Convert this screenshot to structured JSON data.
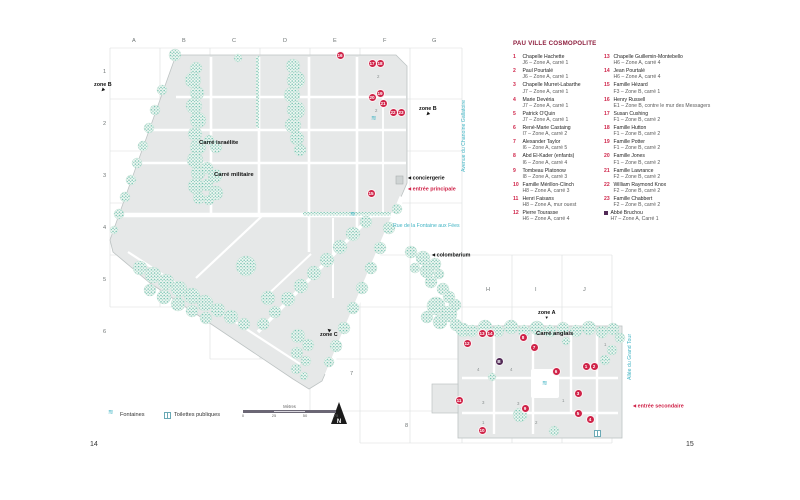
{
  "page": {
    "left_number": "14",
    "right_number": "15"
  },
  "legend_panel": {
    "title": "PAU VILLE COSMOPOLITE",
    "entries_col1": [
      {
        "num": "1",
        "name": "Chapelle Hachette",
        "loc": "J6 – Zone A, carré 1"
      },
      {
        "num": "2",
        "name": "Paul Pourtalé",
        "loc": "J6 – Zone A, carré 1"
      },
      {
        "num": "3",
        "name": "Chapelle Murret-Labarthe",
        "loc": "J7 – Zone A, carré 1"
      },
      {
        "num": "4",
        "name": "Marie Devéria",
        "loc": "J7 – Zone A, carré 1"
      },
      {
        "num": "5",
        "name": "Patrick O'Quin",
        "loc": "J7 – Zone A, carré 1"
      },
      {
        "num": "6",
        "name": "René-Marie Castaing",
        "loc": "I7 – Zone A, carré 2"
      },
      {
        "num": "7",
        "name": "Alexander Taylor",
        "loc": "I6 – Zone A, carré 5"
      },
      {
        "num": "8",
        "name": "Abd El-Kader (enfants)",
        "loc": "I6 – Zone A, carré 4"
      },
      {
        "num": "9",
        "name": "Tombeau Platonow",
        "loc": "I8 – Zone A, carré 3"
      },
      {
        "num": "10",
        "name": "Famille Mérillon-Clinch",
        "loc": "H8 – Zone A, carré 3"
      },
      {
        "num": "11",
        "name": "Henri Faisans",
        "loc": "H8 – Zone A, mur ouest"
      },
      {
        "num": "12",
        "name": "Pierre Tourasse",
        "loc": "H6 – Zone A, carré 4"
      }
    ],
    "entries_col2": [
      {
        "num": "13",
        "name": "Chapelle Guillemin-Montebello",
        "loc": "H6 – Zone A, carré 4"
      },
      {
        "num": "14",
        "name": "Jean Pourtalé",
        "loc": "H6 – Zone A, carré 4"
      },
      {
        "num": "15",
        "name": "Famille Hézard",
        "loc": "F3 – Zone B, carré 1"
      },
      {
        "num": "16",
        "name": "Henry Russell",
        "loc": "E1 – Zone B, contre le mur des Messagers"
      },
      {
        "num": "17",
        "name": "Susan Cushing",
        "loc": "F1 – Zone B, carré 2"
      },
      {
        "num": "18",
        "name": "Famille Hutton",
        "loc": "F1 – Zone B, carré 2"
      },
      {
        "num": "19",
        "name": "Famille Potter",
        "loc": "F1 – Zone B, carré 2"
      },
      {
        "num": "20",
        "name": "Famille Jones",
        "loc": "F1 – Zone B, carré 2"
      },
      {
        "num": "21",
        "name": "Famille Lawrance",
        "loc": "F2 – Zone B, carré 2"
      },
      {
        "num": "22",
        "name": "William Raymond Knox",
        "loc": "F2 – Zone B, carré 2"
      },
      {
        "num": "23",
        "name": "Famille Chabbert",
        "loc": "F2 – Zone B, carré 2"
      },
      {
        "num": "B",
        "square": true,
        "name": "Abbé Bruchou",
        "loc": "H7 – Zone A, Carré 1"
      }
    ]
  },
  "map": {
    "grid": {
      "cols": [
        {
          "label": "A",
          "x": 132,
          "y": 38
        },
        {
          "label": "B",
          "x": 182,
          "y": 38
        },
        {
          "label": "C",
          "x": 232,
          "y": 38
        },
        {
          "label": "D",
          "x": 283,
          "y": 38
        },
        {
          "label": "E",
          "x": 333,
          "y": 38
        },
        {
          "label": "F",
          "x": 383,
          "y": 38
        },
        {
          "label": "G",
          "x": 432,
          "y": 38
        },
        {
          "label": "H",
          "x": 486,
          "y": 287
        },
        {
          "label": "I",
          "x": 535,
          "y": 287
        },
        {
          "label": "J",
          "x": 583,
          "y": 287
        }
      ],
      "rows": [
        {
          "label": "1",
          "x": 103,
          "y": 69
        },
        {
          "label": "2",
          "x": 103,
          "y": 121
        },
        {
          "label": "3",
          "x": 103,
          "y": 173
        },
        {
          "label": "4",
          "x": 103,
          "y": 225
        },
        {
          "label": "5",
          "x": 103,
          "y": 277
        },
        {
          "label": "6",
          "x": 103,
          "y": 329
        },
        {
          "label": "7",
          "x": 350,
          "y": 371
        },
        {
          "label": "8",
          "x": 405,
          "y": 423
        }
      ]
    },
    "zone_labels": [
      {
        "text": "zone B",
        "x": 94,
        "y": 82,
        "dir": "sw",
        "arrow_first": false
      },
      {
        "text": "zone B",
        "x": 419,
        "y": 106,
        "dir": "sw",
        "arrow_first": false
      },
      {
        "text": "zone A",
        "x": 538,
        "y": 310,
        "dir": "s",
        "arrow_first": false
      },
      {
        "text": "zone C",
        "x": 320,
        "y": 328,
        "dir": "nw",
        "arrow_first": true
      }
    ],
    "poi_labels": [
      {
        "text": "conciergerie",
        "x": 408,
        "y": 175,
        "red": false
      },
      {
        "text": "entrée principale",
        "x": 408,
        "y": 186,
        "red": true
      },
      {
        "text": "colombarium",
        "x": 432,
        "y": 252,
        "red": false
      },
      {
        "text": "entrée secondaire",
        "x": 633,
        "y": 403,
        "red": true
      }
    ],
    "area_labels": [
      {
        "text": "Carré israélite",
        "x": 199,
        "y": 140
      },
      {
        "text": "Carré militaire",
        "x": 214,
        "y": 172
      },
      {
        "text": "Carré anglais",
        "x": 536,
        "y": 331
      }
    ],
    "streets": [
      {
        "text": "Avenue du Chanoine Gallatoire",
        "x": 461,
        "y": 172,
        "vertical": true
      },
      {
        "text": "Rue de la Fontaine aux Fées",
        "x": 393,
        "y": 223,
        "vertical": false
      },
      {
        "text": "Allée du Grand Tour",
        "x": 627,
        "y": 380,
        "vertical": true
      }
    ],
    "markers": [
      {
        "n": "1",
        "x": 586,
        "y": 366
      },
      {
        "n": "2",
        "x": 594,
        "y": 366
      },
      {
        "n": "3",
        "x": 578,
        "y": 393
      },
      {
        "n": "4",
        "x": 590,
        "y": 419
      },
      {
        "n": "5",
        "x": 578,
        "y": 413
      },
      {
        "n": "6",
        "x": 556,
        "y": 371
      },
      {
        "n": "7",
        "x": 534,
        "y": 347
      },
      {
        "n": "8",
        "x": 523,
        "y": 337
      },
      {
        "n": "9",
        "x": 525,
        "y": 408
      },
      {
        "n": "10",
        "x": 482,
        "y": 430
      },
      {
        "n": "11",
        "x": 459,
        "y": 400
      },
      {
        "n": "12",
        "x": 467,
        "y": 343
      },
      {
        "n": "13",
        "x": 482,
        "y": 333
      },
      {
        "n": "14",
        "x": 490,
        "y": 333
      },
      {
        "n": "15",
        "x": 371,
        "y": 193
      },
      {
        "n": "16",
        "x": 340,
        "y": 55
      },
      {
        "n": "17",
        "x": 372,
        "y": 63
      },
      {
        "n": "18",
        "x": 380,
        "y": 63
      },
      {
        "n": "19",
        "x": 380,
        "y": 93
      },
      {
        "n": "20",
        "x": 372,
        "y": 97
      },
      {
        "n": "21",
        "x": 383,
        "y": 103
      },
      {
        "n": "22",
        "x": 393,
        "y": 112
      },
      {
        "n": "23",
        "x": 401,
        "y": 112
      },
      {
        "n": "B",
        "x": 499,
        "y": 361,
        "purple": true
      }
    ],
    "block_numbers": [
      {
        "t": "2",
        "x": 377,
        "y": 74
      },
      {
        "t": "2",
        "x": 375,
        "y": 108
      },
      {
        "t": "4",
        "x": 477,
        "y": 367
      },
      {
        "t": "4",
        "x": 510,
        "y": 367
      },
      {
        "t": "3",
        "x": 482,
        "y": 400
      },
      {
        "t": "3",
        "x": 517,
        "y": 401
      },
      {
        "t": "1",
        "x": 562,
        "y": 398
      },
      {
        "t": "1",
        "x": 482,
        "y": 420
      },
      {
        "t": "2",
        "x": 535,
        "y": 420
      },
      {
        "t": "1",
        "x": 604,
        "y": 342
      }
    ],
    "fountains": [
      {
        "x": 374,
        "y": 119
      },
      {
        "x": 353,
        "y": 215
      },
      {
        "x": 545,
        "y": 384
      }
    ],
    "toilets": [
      {
        "x": 597,
        "y": 433
      }
    ]
  },
  "bottom_legend": {
    "fountains_label": "Fontaines",
    "toilets_label": "Toilettes publiques",
    "scale": {
      "title": "Mètres",
      "ticks": [
        "0",
        "25",
        "50",
        "75"
      ]
    },
    "north_label": "N"
  },
  "colors": {
    "accent_red": "#cf2348",
    "marker_purple": "#522a56",
    "street_teal": "#3fb3c3",
    "tree_green": "#6fbfad",
    "block_gray": "#e6e8e8"
  }
}
